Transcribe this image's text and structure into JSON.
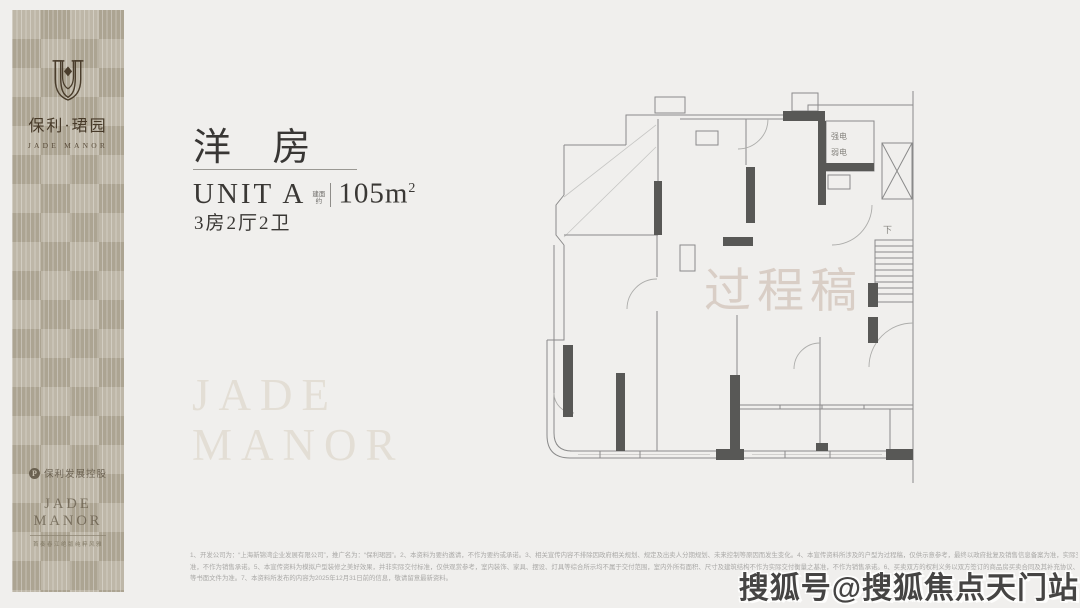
{
  "brand": {
    "name_cn": "保利·珺园",
    "name_en": "JADE MANOR",
    "developer": "保利发展控股",
    "developer_mark": "P",
    "footer_title": "JADE MANOR",
    "footer_tagline": "首奏春江绝版纯粹风雅"
  },
  "unit": {
    "title": "洋 房",
    "unit_label": "UNIT A",
    "area_prefix_top": "建面",
    "area_prefix_bottom": "约",
    "area_value": "105m",
    "area_sup": "2",
    "layout": "3房2厅2卫"
  },
  "watermarks": {
    "large_line1": "JADE",
    "large_line2": "MANOR",
    "draft_stamp": "过程稿",
    "sohu": "搜狐号@搜狐焦点天门站"
  },
  "floorplan": {
    "labels": {
      "strong_electric": "强电",
      "weak_electric": "弱电",
      "down": "下"
    }
  },
  "disclaimer": {
    "lines": [
      "1、开发公司为：“上海新锦湾企业发展有限公司”，推广名为：“保利珺园”。2、本资料为要约邀请，不作为要约或承诺。3、相关宣传内容不排除因政府相关规划、规定及出卖人分期规划、未来控制等原因而发生变化。4、本宣传资料所涉及的户型为过程稿，仅供示意参考，最终以政府批复及销售信息备案为准，实际交付标",
      "准，不作为销售承诺。5、本宣传资料为模拟户型装修之美好效果，并非实际交付标准，仅供观赏参考，室内装饰、家具、摆设、灯具等综合所示均不属于交付范围，室内外所有面积、尺寸及建筑结构不作为实际交付衡量之基准，不作为销售承诺。6、买卖双方的权利义务以双方签订的商品房买卖合同及其补充协议、附件",
      "等书面文件为准。7、本资料所发布的内容为2025年12月31日前的信息，敬请留意最新资料。"
    ]
  },
  "colors": {
    "page_bg": "#f0efed",
    "panel_bg": "#b5ad9c",
    "brand_dark": "#473a29",
    "title_text": "#383634",
    "pale_watermark": "#e3ded5",
    "draft_stamp": "#d9cec6",
    "plan_line": "#8a8a8a",
    "plan_fill": "#585856",
    "disclaimer_text": "#aaa9a7",
    "sohu_text": "#454443"
  }
}
